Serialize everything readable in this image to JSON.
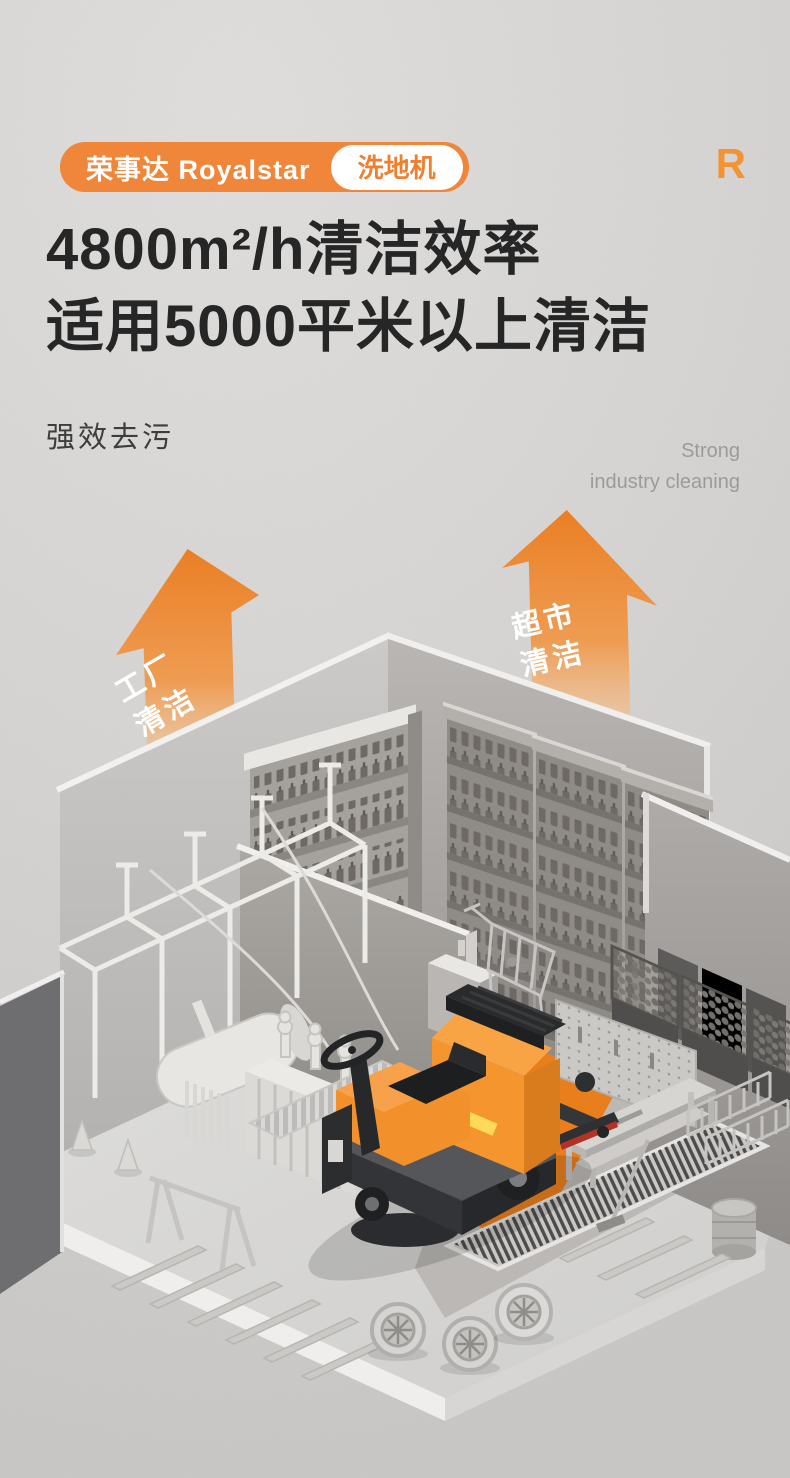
{
  "header": {
    "brand": "荣事达 Royalstar",
    "product_tag": "洗地机",
    "logo_letter": "R"
  },
  "headline": {
    "line1": "4800m²/h清洁效率",
    "line2": "适用5000平米以上清洁"
  },
  "subheading": {
    "cn": "强效去污",
    "en_line1": "Strong",
    "en_line2": "industry cleaning"
  },
  "annotations": {
    "factory_arrow": {
      "line1": "工厂",
      "line2": "清洁"
    },
    "supermarket_arrow": {
      "line1": "超市",
      "line2": "清洁"
    }
  },
  "colors": {
    "accent_orange": "#f0863a",
    "path_orange": "#e87e1c",
    "machine_orange": "#f5952e",
    "ink": "#262626",
    "muted_gray": "#9b9b9b",
    "background_gray": "#d5d4d2"
  }
}
